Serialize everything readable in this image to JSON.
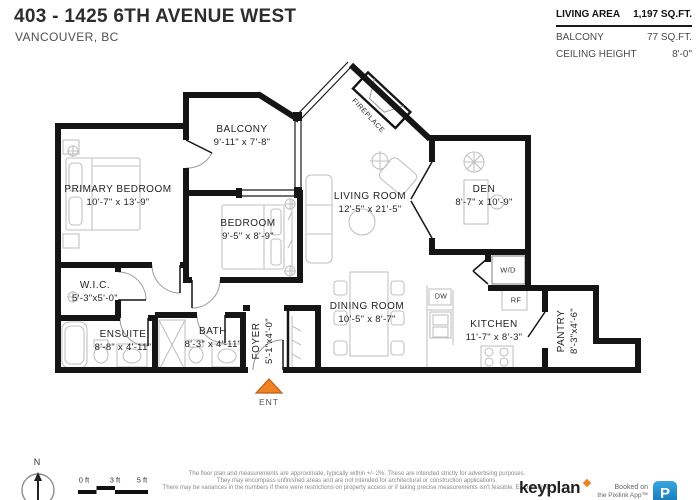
{
  "header": {
    "title": "403 - 1425 6TH AVENUE WEST",
    "subtitle": "VANCOUVER, BC"
  },
  "stats": {
    "living_area": {
      "label": "LIVING AREA",
      "value": "1,197 SQ.FT."
    },
    "balcony": {
      "label": "BALCONY",
      "value": "77 SQ.FT."
    },
    "ceiling_height": {
      "label": "CEILING HEIGHT",
      "value": "8'-0\""
    }
  },
  "rooms": {
    "balcony": {
      "name": "BALCONY",
      "dims": "9'-11\" x 7'-8\""
    },
    "primary_bedroom": {
      "name": "PRIMARY BEDROOM",
      "dims": "10'-7\" x 13'-9\""
    },
    "bedroom": {
      "name": "BEDROOM",
      "dims": "9'-5\" x 8'-9\""
    },
    "living_room": {
      "name": "LIVING ROOM",
      "dims": "12'-5\" x 21'-5\""
    },
    "den": {
      "name": "DEN",
      "dims": "8'-7\" x 10'-9\""
    },
    "wic": {
      "name": "W.I.C.",
      "dims": "5'-3\"x5'-0\""
    },
    "ensuite": {
      "name": "ENSUITE",
      "dims": "8'-8\" x 4'-11\""
    },
    "bath": {
      "name": "BATH",
      "dims": "8'-3\" x 4'-11\""
    },
    "foyer": {
      "name": "FOYER",
      "dims": "5'-1\"x4'-0\""
    },
    "dining_room": {
      "name": "DINING ROOM",
      "dims": "10'-5\" x 8'-7\""
    },
    "kitchen": {
      "name": "KITCHEN",
      "dims": "11'-7\" x 8'-3\""
    },
    "pantry": {
      "name": "PANTRY",
      "dims": "8'-3\"x4'-6\""
    }
  },
  "annotations": {
    "fireplace": "FIREPLACE",
    "washer_dryer": "W/D",
    "fridge": "RF",
    "dishwasher": "DW",
    "entry": "ENT",
    "north": "N"
  },
  "scale_bar": {
    "ticks": [
      "0 ft",
      "3 ft",
      "5 ft"
    ]
  },
  "footer": {
    "disclaimer_lines": [
      "The floor plan and measurements are approximate, typically within +/- 2%. These are intended strictly for advertising purposes.",
      "They may encompass unfinished areas and are not intended for architectural or construction applications.",
      "There may be variances in the numbers if there were restrictions on property access or if taking precise measurements isn't feasible. E&O insured."
    ],
    "brand": "keyplan",
    "booked_on": "Booked on",
    "app_name": "the Pixilink App™",
    "app_letter": "P"
  },
  "colors": {
    "accent_orange": "#F08125",
    "app_blue": "#1E87C8",
    "wall": "#151515"
  }
}
